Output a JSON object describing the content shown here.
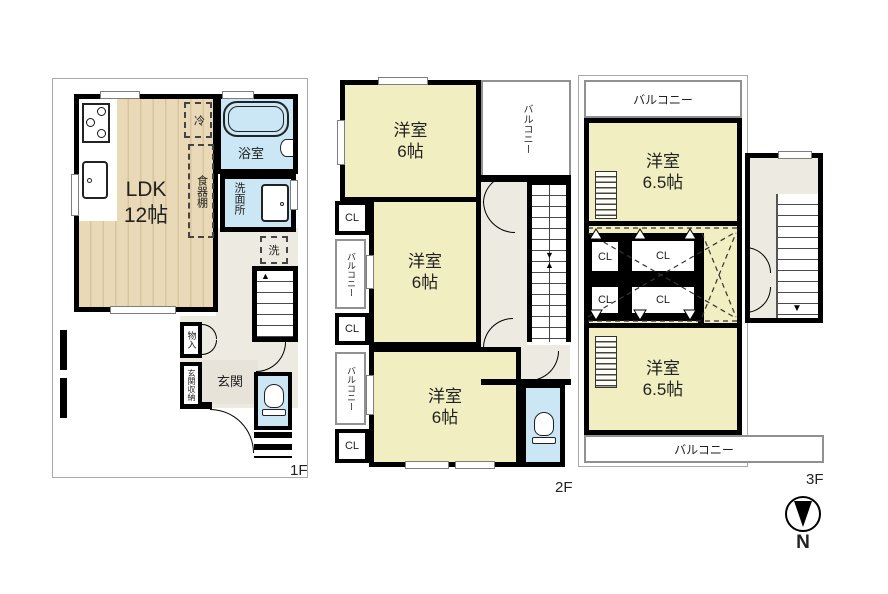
{
  "floors": {
    "f1": {
      "label": "1F",
      "ldk_name": "LDK",
      "ldk_size": "12帖",
      "fridge": "冷",
      "cupboard": "食器棚",
      "bath": "浴室",
      "washroom": "洗面所",
      "laundry": "洗",
      "storage": "物入",
      "entrance_storage": "玄関収納",
      "entrance": "玄関"
    },
    "f2": {
      "label": "2F",
      "room": "洋室",
      "size": "6帖",
      "balcony": "バルコニー",
      "cl": "CL"
    },
    "f3": {
      "label": "3F",
      "room": "洋室",
      "size": "6.5帖",
      "balcony": "バルコニー",
      "cl": "CL"
    }
  },
  "compass": {
    "north": "N"
  },
  "colors": {
    "wall": "#000000",
    "western_room": "#f1eec1",
    "wood_floor": "#e9d9b6",
    "wet_area": "#cbe6f4",
    "hallway": "#edeae1",
    "balcony_border": "#919191"
  }
}
